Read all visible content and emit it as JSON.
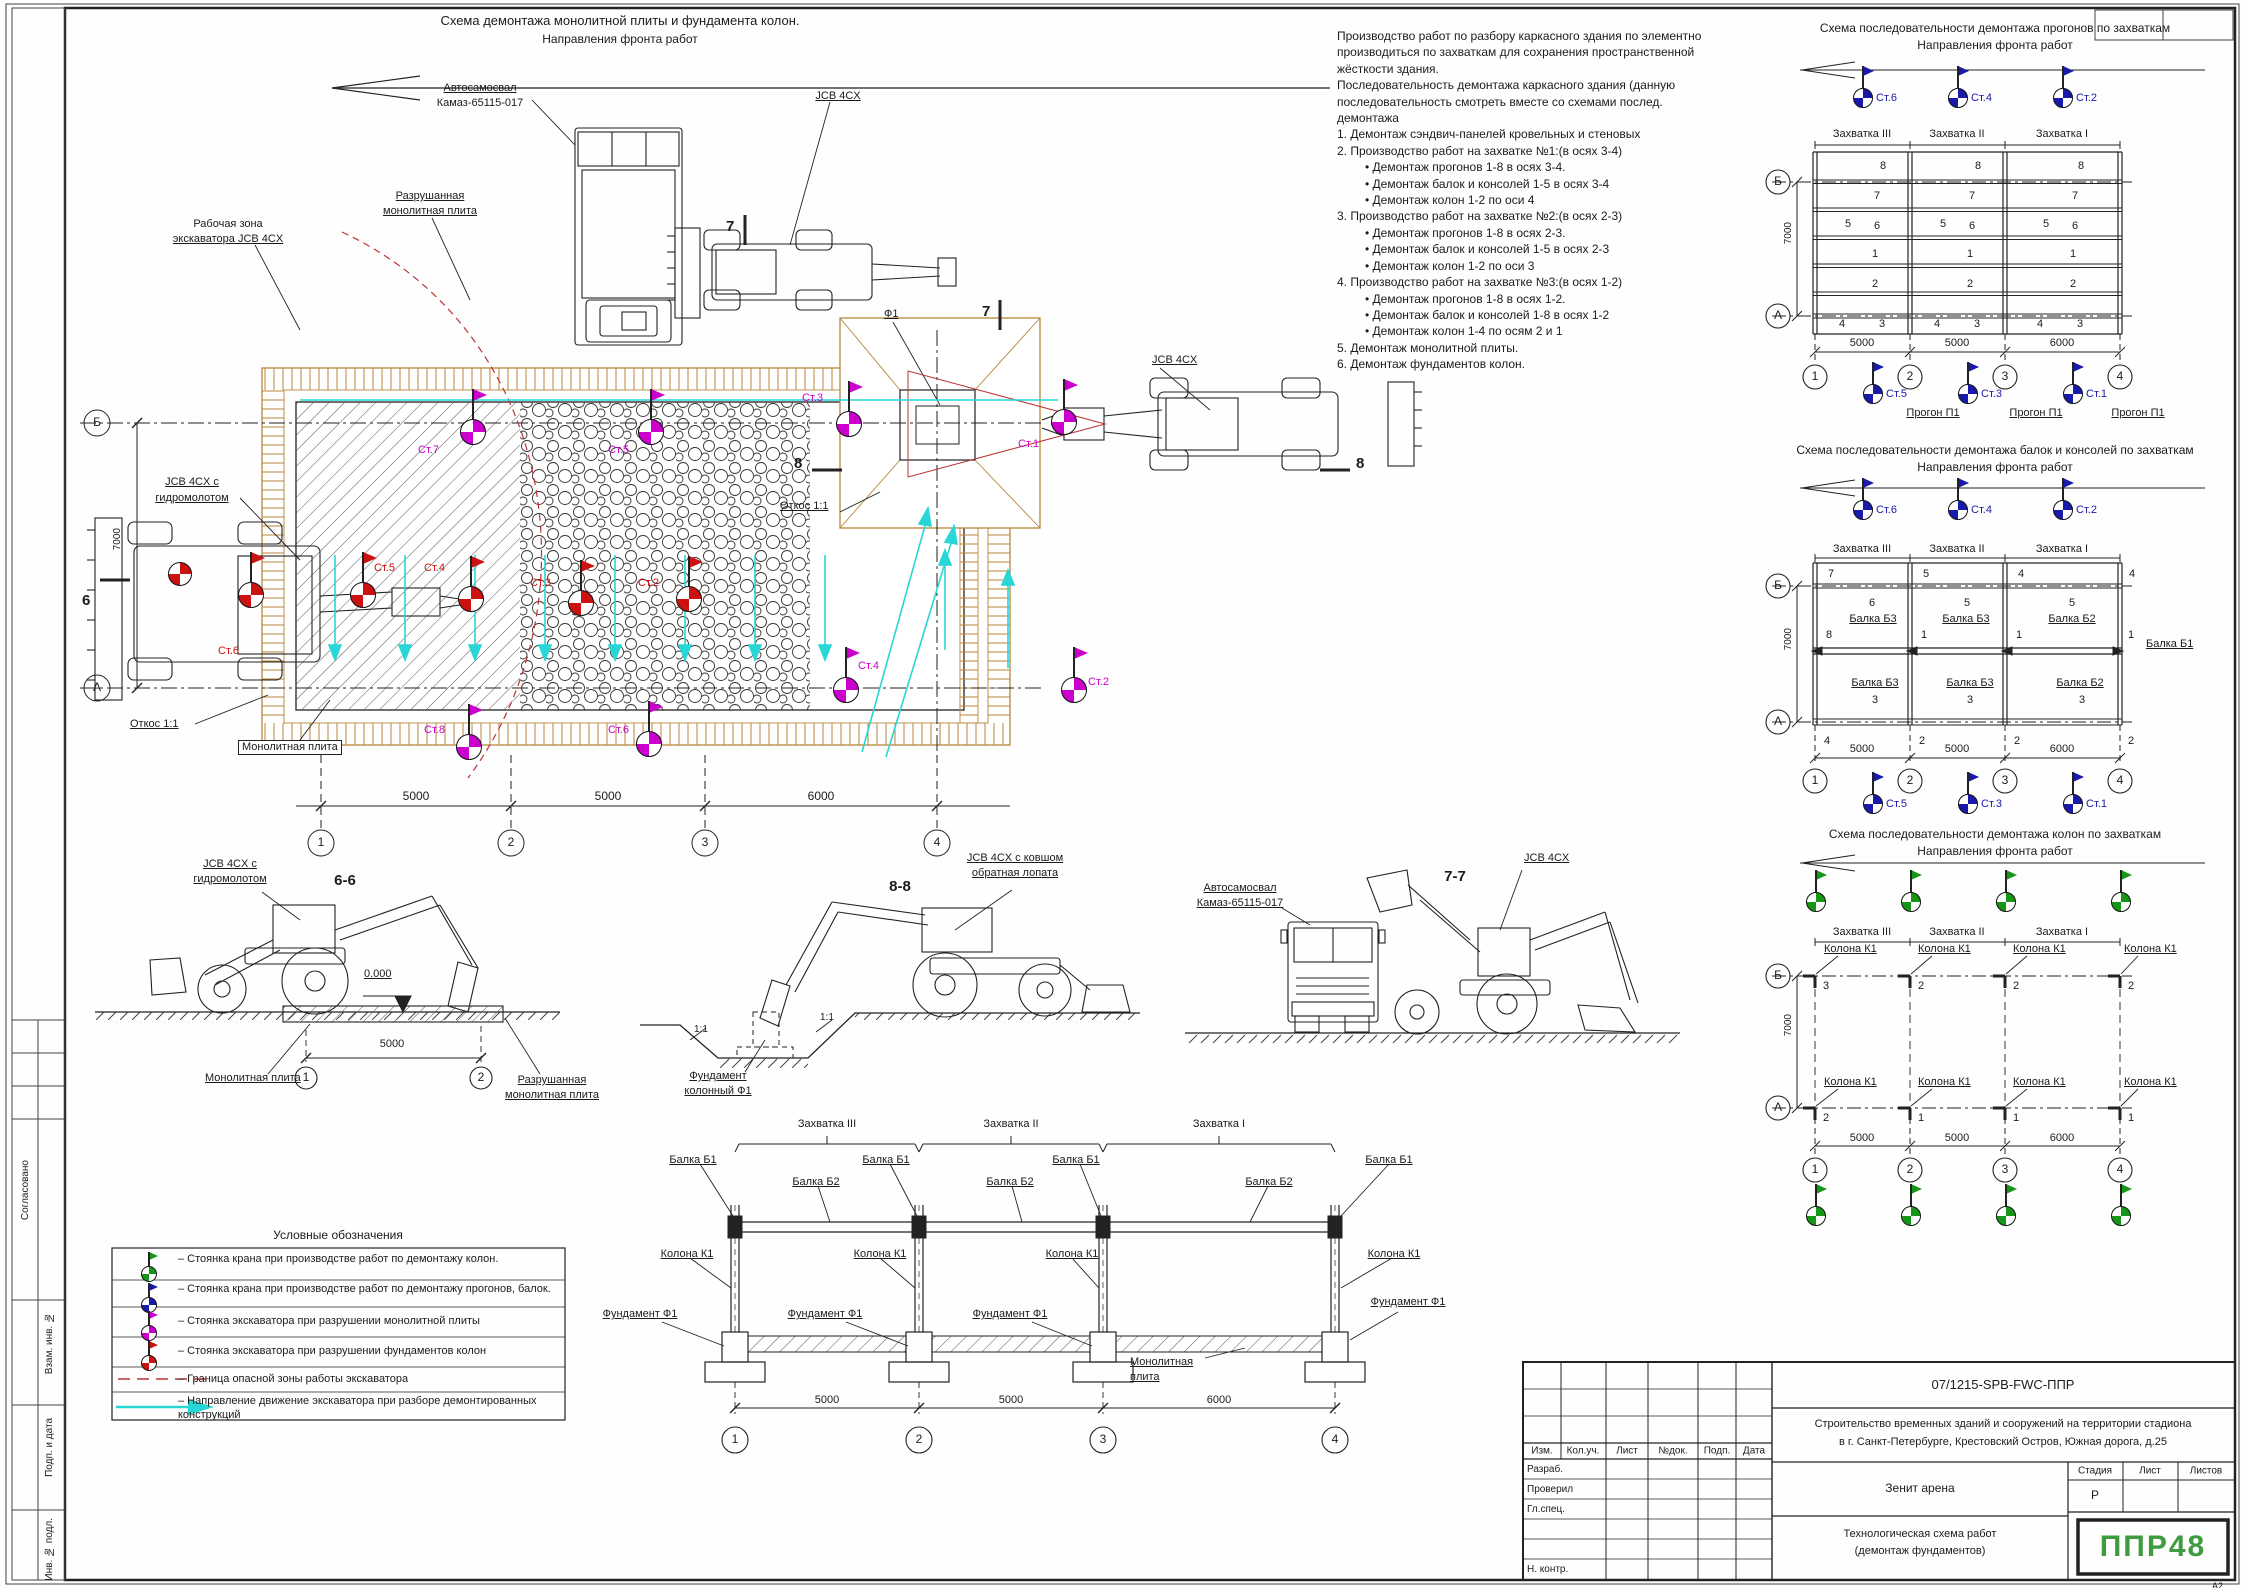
{
  "palette": {
    "red": "#cc1111",
    "magenta": "#cc00cc",
    "blue": "#1a1aaa",
    "green": "#169616",
    "cyan": "#2fd8d8",
    "tan": "#b8863b",
    "logo_green": "#3f9b3f"
  },
  "plan": {
    "title": "Схема демонтажа монолитной плиты и фундамента колон.",
    "front": "Направления фронта работ",
    "truck1": "Автосамосвал",
    "truck2": "Камаз-65115-017",
    "jcb_top": "JCB 4CX",
    "zone1": "Рабочая зона",
    "zone2": "экскаватора JCB 4CX",
    "destroyed1": "Разрушанная",
    "destroyed2": "монолитная плита",
    "hydro1": "JCB 4CX с",
    "hydro2": "гидромолотом",
    "f1": "Ф1",
    "jcb_right": "JCB 4CX",
    "otkos": "Откос 1:1",
    "slab": "Монолитная плита",
    "dim_v": "7000",
    "dims": [
      "5000",
      "5000",
      "6000"
    ],
    "axis_b": "Б",
    "axis_a": "А",
    "cols": [
      "1",
      "2",
      "3",
      "4"
    ],
    "sec6": "6",
    "sec7": "7",
    "sec8": "8",
    "red_st": [
      "Ст.6",
      "Ст.5",
      "Ст.4",
      "Ст.3",
      "Ст.2"
    ],
    "mag_st": [
      "Ст.7",
      "Ст.5",
      "Ст.8",
      "Ст.6",
      "Ст.3",
      "Ст.1",
      "Ст.4",
      "Ст.2"
    ]
  },
  "notes": {
    "lines": [
      "Производство работ по разбору каркасного здания по элементно",
      "производиться по захваткам для сохранения пространственной",
      "жёсткости здания.",
      "Последовательность демонтажа каркасного здания (данную",
      "последовательность смотреть вместе со схемами послед.",
      "демонтажа",
      "1. Демонтаж сэндвич-панелей кровельных и стеновых",
      "2. Производство работ на захватке №1:(в осях 3-4)",
      "• Демонтаж прогонов 1-8 в осях 3-4.",
      "• Демонтаж балок и консолей 1-5 в осях 3-4",
      "• Демонтаж колон 1-2 по оси 4",
      "3. Производство работ на захватке №2:(в осях 2-3)",
      "• Демонтаж прогонов 1-8 в осях 2-3.",
      "• Демонтаж балок и консолей 1-5 в осях 2-3",
      "• Демонтаж колон 1-2 по оси 3",
      "4. Производство работ на захватке №3:(в осях 1-2)",
      "• Демонтаж прогонов 1-8 в осях 1-2.",
      "• Демонтаж балок и консолей 1-8 в осях 1-2",
      "• Демонтаж колон 1-4 по осям 2 и 1",
      "5. Демонтаж монолитной плиты.",
      "6. Демонтаж фундаментов колон."
    ]
  },
  "s1": {
    "title": "Схема последовательности демонтажа прогонов по захваткам",
    "front": "Направления фронта работ",
    "zah": [
      "Захватка III",
      "Захватка II",
      "Захватка I"
    ],
    "tf": [
      "Ст.6",
      "Ст.4",
      "Ст.2"
    ],
    "bf": [
      "Ст.5",
      "Ст.3",
      "Ст.1"
    ],
    "n": [
      "8",
      "7",
      "5",
      "6",
      "1",
      "2"
    ],
    "nb": [
      "4",
      "3"
    ],
    "progon": "Прогон П1",
    "dim_v": "7000",
    "dims": [
      "5000",
      "5000",
      "6000"
    ],
    "axis_b": "Б",
    "axis_a": "А",
    "cols": [
      "1",
      "2",
      "3",
      "4"
    ]
  },
  "s2": {
    "title": "Схема последовательности демонтажа балок и консолей по захваткам",
    "front": "Направления фронта работ",
    "zah": [
      "Захватка III",
      "Захватка II",
      "Захватка I"
    ],
    "tf": [
      "Ст.6",
      "Ст.4",
      "Ст.2"
    ],
    "bf": [
      "Ст.5",
      "Ст.3",
      "Ст.1"
    ],
    "top": [
      "7",
      "5",
      "4",
      "4"
    ],
    "mid": [
      "6",
      "5",
      "5"
    ],
    "bt": [
      "Балка Б3",
      "Балка Б3",
      "Балка Б2"
    ],
    "n8": "8",
    "ones": [
      "1",
      "1",
      "1"
    ],
    "b1": "Балка Б1",
    "bb": [
      "Балка Б3",
      "Балка Б3",
      "Балка Б2"
    ],
    "threes": [
      "3",
      "3",
      "3"
    ],
    "bot": [
      "4",
      "2",
      "2",
      "2"
    ],
    "dim_v": "7000",
    "dims": [
      "5000",
      "5000",
      "6000"
    ],
    "axis_b": "Б",
    "axis_a": "А",
    "cols": [
      "1",
      "2",
      "3",
      "4"
    ]
  },
  "s3": {
    "title": "Схема последовательности демонтажа колон по захваткам",
    "front": "Направления фронта работ",
    "zah": [
      "Захватка III",
      "Захватка II",
      "Захватка I"
    ],
    "kol": "Колона К1",
    "top": [
      "3",
      "2",
      "2",
      "2"
    ],
    "bot": [
      "2",
      "1",
      "1",
      "1"
    ],
    "dim_v": "7000",
    "dims": [
      "5000",
      "5000",
      "6000"
    ],
    "axis_b": "Б",
    "axis_a": "А",
    "cols": [
      "1",
      "2",
      "3",
      "4"
    ]
  },
  "legend": {
    "title": "Условные обозначения",
    "i1": "– Стоянка крана при производстве работ по демонтажу колон.",
    "i2": "– Стоянка крана при производстве работ по демонтажу прогонов, балок.",
    "i3": "– Стоянка экскаватора при разрушении монолитной плиты",
    "i4": "– Стоянка экскаватора при разрушении фундаментов колон",
    "i5": "– Граница опасной зоны работы экскаватора",
    "i6": "– Направление движение экскаватора при разборе демонтированных конструкций"
  },
  "s66": {
    "name": "6-6",
    "l1": "JCB 4CX с",
    "l2": "гидромолотом",
    "level": "0.000",
    "dim": "5000",
    "c1": "1",
    "c2": "2",
    "slab": "Монолитная плита",
    "d1": "Разрушанная",
    "d2": "монолитная плита"
  },
  "s88": {
    "name": "8-8",
    "l1": "JCB 4CX с ковшом",
    "l2": "обратная лопата",
    "f1": "Фундамент",
    "f2": "колонный Ф1",
    "slope": "1:1"
  },
  "s77": {
    "name": "7-7",
    "t1": "Автосамосвал",
    "t2": "Камаз-65115-017",
    "jcb": "JCB 4CX"
  },
  "elev": {
    "zah": [
      "Захватка III",
      "Захватка II",
      "Захватка I"
    ],
    "b1": "Балка Б1",
    "b2": "Балка Б2",
    "kol": "Колона К1",
    "fund": "Фундамент Ф1",
    "slab1": "Монолитная",
    "slab2": "плита",
    "dims": [
      "5000",
      "5000",
      "6000"
    ],
    "cols": [
      "1",
      "2",
      "3",
      "4"
    ]
  },
  "tb": {
    "doc": "07/1215-SPB-FWC-ППР",
    "p1": "Строительство временных зданий и сооружений на территории стадиона",
    "p2": "в г. Санкт-Петербурге, Крестовский Остров, Южная дорога, д.25",
    "object": "Зенит арена",
    "t1": "Технологическая схема работ",
    "t2": "(демонтаж фундаментов)",
    "stage_l": "Стадия",
    "sheet_l": "Лист",
    "sheets_l": "Листов",
    "stage": "Р",
    "h": [
      "Изм.",
      "Кол.уч.",
      "Лист",
      "№док.",
      "Подп.",
      "Дата"
    ],
    "rows": [
      "Разраб.",
      "Проверил",
      "Гл.спец.",
      "Н. контр."
    ],
    "logo": "ППР48",
    "format": "А2"
  },
  "strip": [
    "Согласовано",
    "Взам. инв. №",
    "Подп. и дата",
    "Инв. № подл."
  ]
}
